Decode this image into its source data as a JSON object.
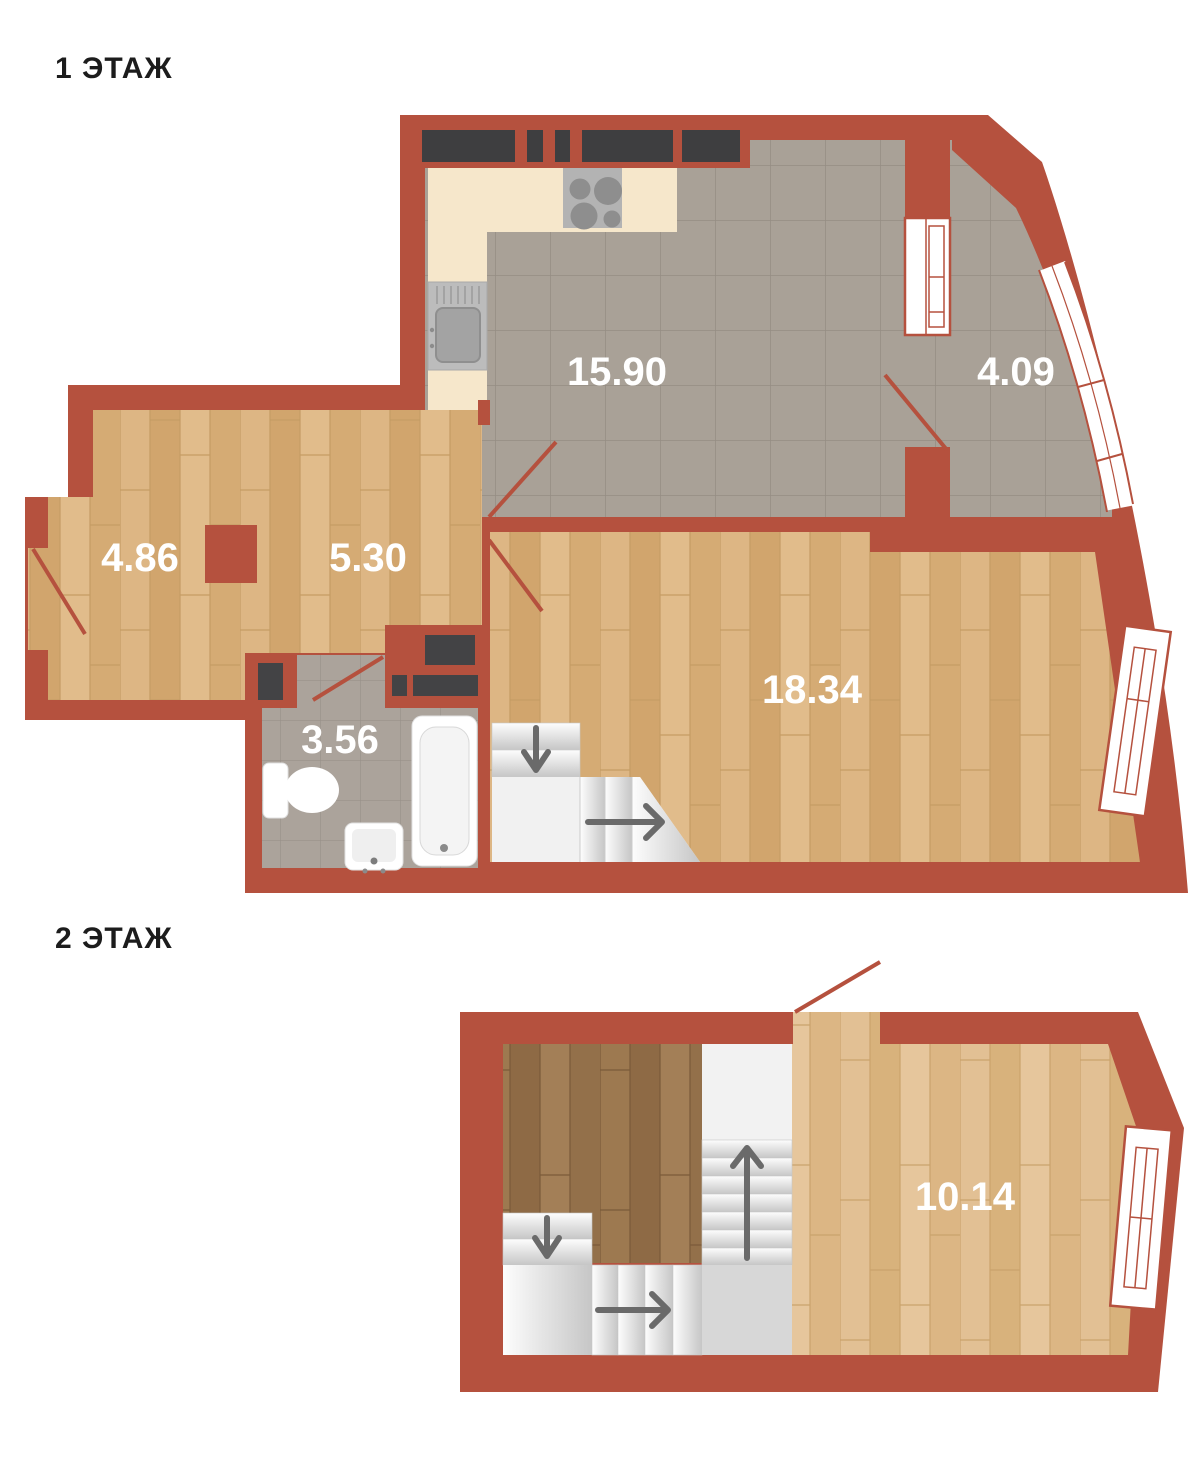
{
  "floor1": {
    "title": "1 ЭТАЖ",
    "rooms": {
      "kitchen_living": "15.90",
      "balcony": "4.09",
      "room_small": "4.86",
      "hall": "5.30",
      "bathroom": "3.56",
      "living": "18.34"
    }
  },
  "floor2": {
    "title": "2 ЭТАЖ",
    "rooms": {
      "room": "10.14"
    }
  },
  "colors": {
    "wall": "#b5513e",
    "room_label": "#ffffff",
    "floor_title": "#1c1c1c",
    "wood_floor": "#d8af7a",
    "dark_wood_floor": "#96714a",
    "tile_floor": "#a9a197",
    "counter": "#f6e7cb",
    "cabinet": "#3e3e40",
    "stairs": "#f1f1f1",
    "arrow": "#6a6a6a"
  }
}
